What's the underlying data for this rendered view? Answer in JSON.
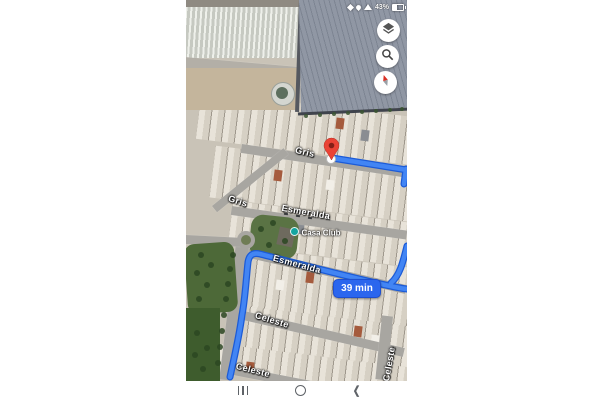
{
  "status_bar": {
    "battery_text": "43%"
  },
  "map": {
    "street_labels": [
      {
        "text": "Gris"
      },
      {
        "text": "Gris"
      },
      {
        "text": "Esmeralda"
      },
      {
        "text": "Esmeralda"
      },
      {
        "text": "Celeste"
      },
      {
        "text": "Celeste"
      },
      {
        "text": "Celeste"
      }
    ],
    "poi_label": "Casa Club",
    "route_badge": "39 min",
    "icons": [
      "layers-icon",
      "search-icon",
      "compass-icon",
      "share-icon",
      "location-icon",
      "wifi-icon",
      "battery-icon",
      "recents-icon",
      "home-icon",
      "back-icon",
      "destination-pin"
    ]
  },
  "colors": {
    "route": "#4285f4",
    "route_casing": "#1c5bd7",
    "badge_blue": "#2b66ee",
    "pin_red": "#ea4335",
    "pin_inner": "#841f17",
    "poi_dot": "#14a5a0"
  }
}
